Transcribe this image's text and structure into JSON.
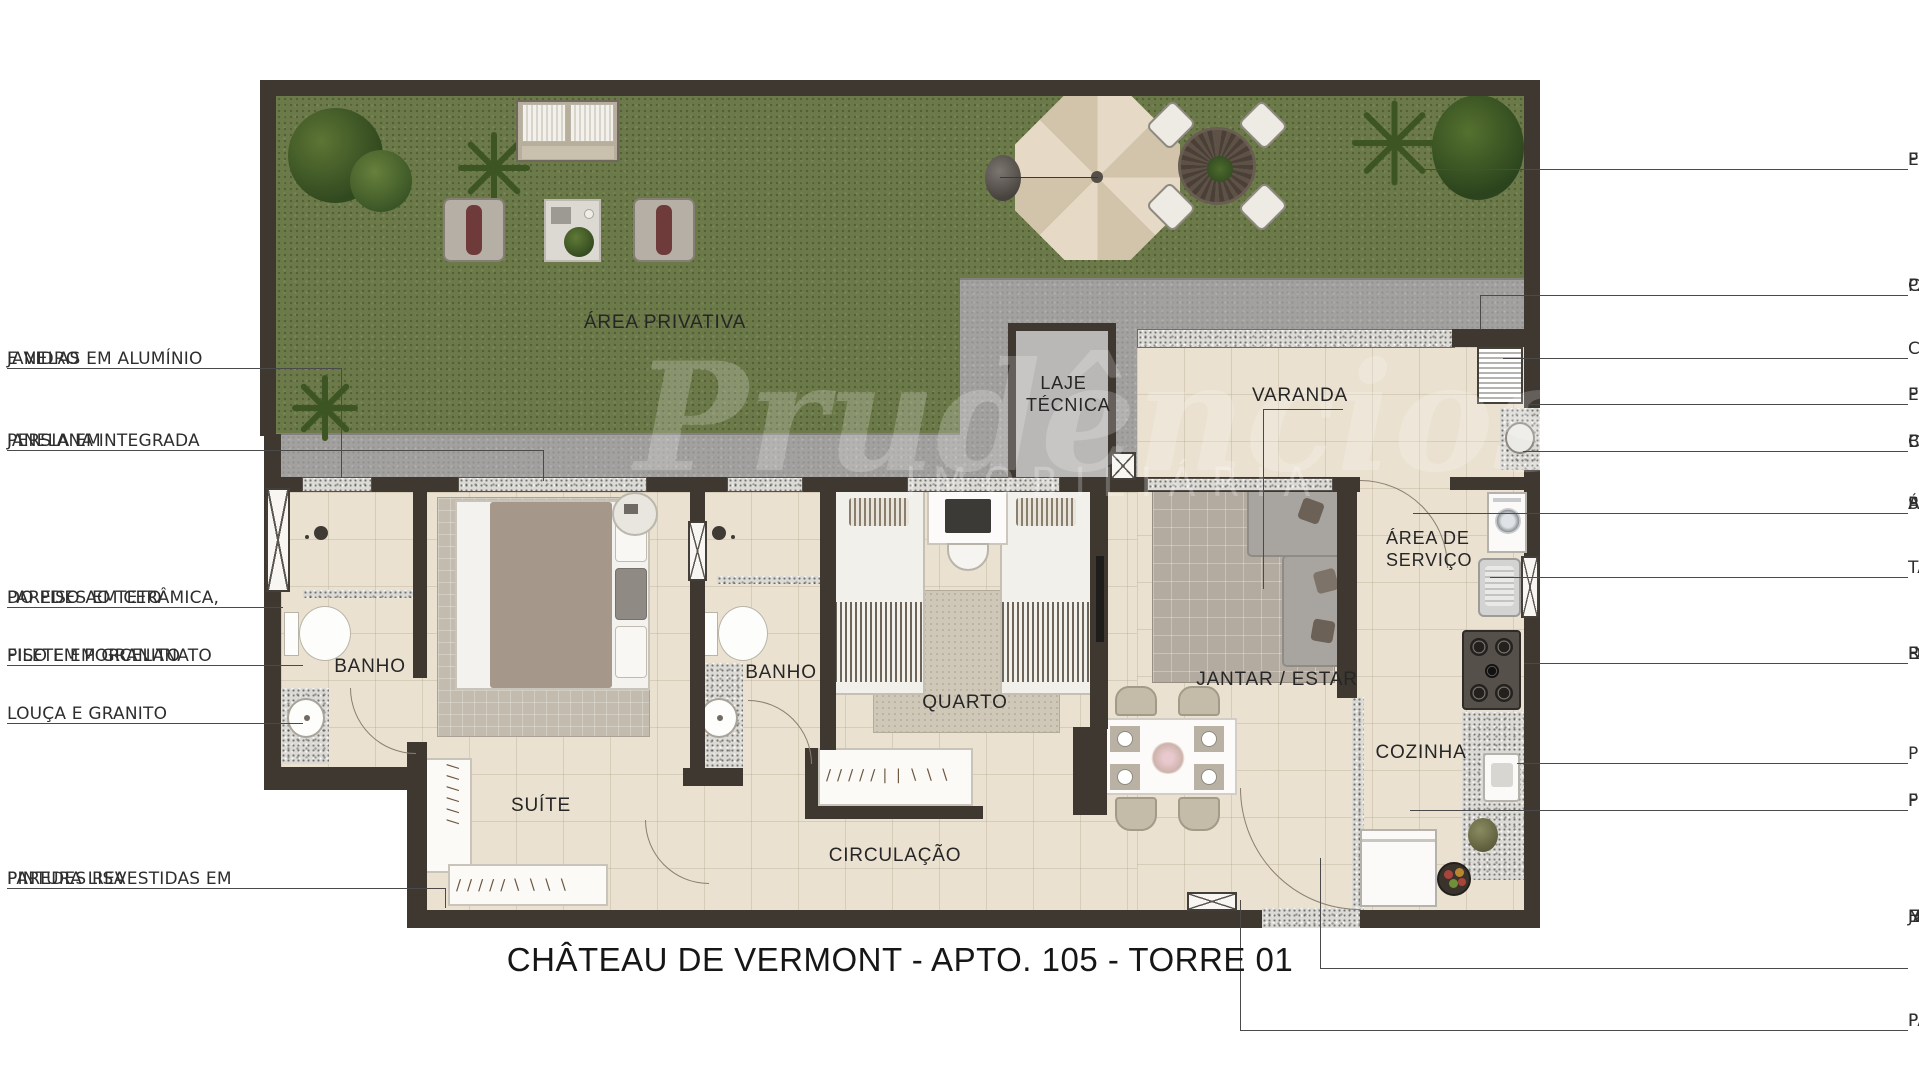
{
  "title": "CHÂTEAU DE VERMONT - APTO. 105 - TORRE 01",
  "watermark": {
    "brand": "Prudêncios",
    "tagline": "IMOBILIÁRIA"
  },
  "rooms": {
    "area_privativa": "ÁREA PRIVATIVA",
    "laje_tecnica": "LAJE TÉCNICA",
    "varanda": "VARANDA",
    "area_servico": "ÁREA DE SERVIÇO",
    "banho_1": "BANHO",
    "banho_2": "BANHO",
    "quarto": "QUARTO",
    "jantar_estar": "JANTAR / ESTAR",
    "cozinha": "COZINHA",
    "suite": "SUÍTE",
    "circulacao": "CIRCULAÇÃO"
  },
  "annotations_left": [
    {
      "lines": [
        "JANELAS EM ALUMÍNIO",
        "E VIDRO"
      ]
    },
    {
      "lines": [
        "JANELA EM",
        "PERSIANA INTEGRADA"
      ]
    },
    {
      "lines": [
        "PAREDES EM CERÂMICA,",
        "DO PISO AO TETO"
      ]
    },
    {
      "lines": [
        "PISO EM PORCELANATO",
        "FILETE EM GRANITO"
      ]
    },
    {
      "lines": [
        "LOUÇA E GRANITO"
      ]
    },
    {
      "lines": [
        "PAREDES REVESTIDAS EM",
        "PINTURA LISA"
      ]
    }
  ],
  "annotations_right": [
    {
      "lines": [
        "PISO CIMENTADO",
        "E/OU GRAMADO"
      ]
    },
    {
      "lines": [
        "PAREDE SERÁ REVESTIDA",
        "CONFORME FACHADA"
      ]
    },
    {
      "lines": [
        "CHURRASQUEIRA"
      ]
    },
    {
      "lines": [
        "PORTA EM ALUMÍNIO",
        "E VIDRO"
      ]
    },
    {
      "lines": [
        "BANCADA EM GRANITO,",
        "CUBA EM INOX"
      ]
    },
    {
      "lines": [
        "ÁREA DE SERVIÇO E VARANDA",
        "SERÃO ENTREGUES COM",
        "PISO EM PORCELANATO."
      ]
    },
    {
      "lines": [
        "TANQUE EM LOUÇA"
      ]
    },
    {
      "lines": [
        "REVESTIMENTO ATÉ 150 CM",
        "DA PAREDE HIDRÁULICA, O",
        "RESTANTE SERÁ REVESTIDO",
        "EM PINTURA LISA."
      ]
    },
    {
      "lines": [
        "PREVISÃO DE BANCADA"
      ]
    },
    {
      "lines": [
        "PISO EM PORCELANATO",
        "FILETE EM GRANITO"
      ]
    },
    {
      "lines": [
        "JANTAR / ESTAR, CIRCULAÇÃO",
        "E DORMITÓRIOS SERÃO",
        "ENTREGUES COM PISO",
        "NIVELADO SEM REVESTIMENTO."
      ]
    },
    {
      "lines": [
        "PAREDES REVESTIDAS EM",
        "PINTURA LISA"
      ]
    }
  ],
  "colors": {
    "wall": "#3e3831",
    "grass": "#6c7a4a",
    "concrete": "#a2a19f",
    "floor": "#eae1d0",
    "granite": "#dcdad5",
    "leader_line": "#4a4a4a",
    "text": "#2e2e2e"
  }
}
